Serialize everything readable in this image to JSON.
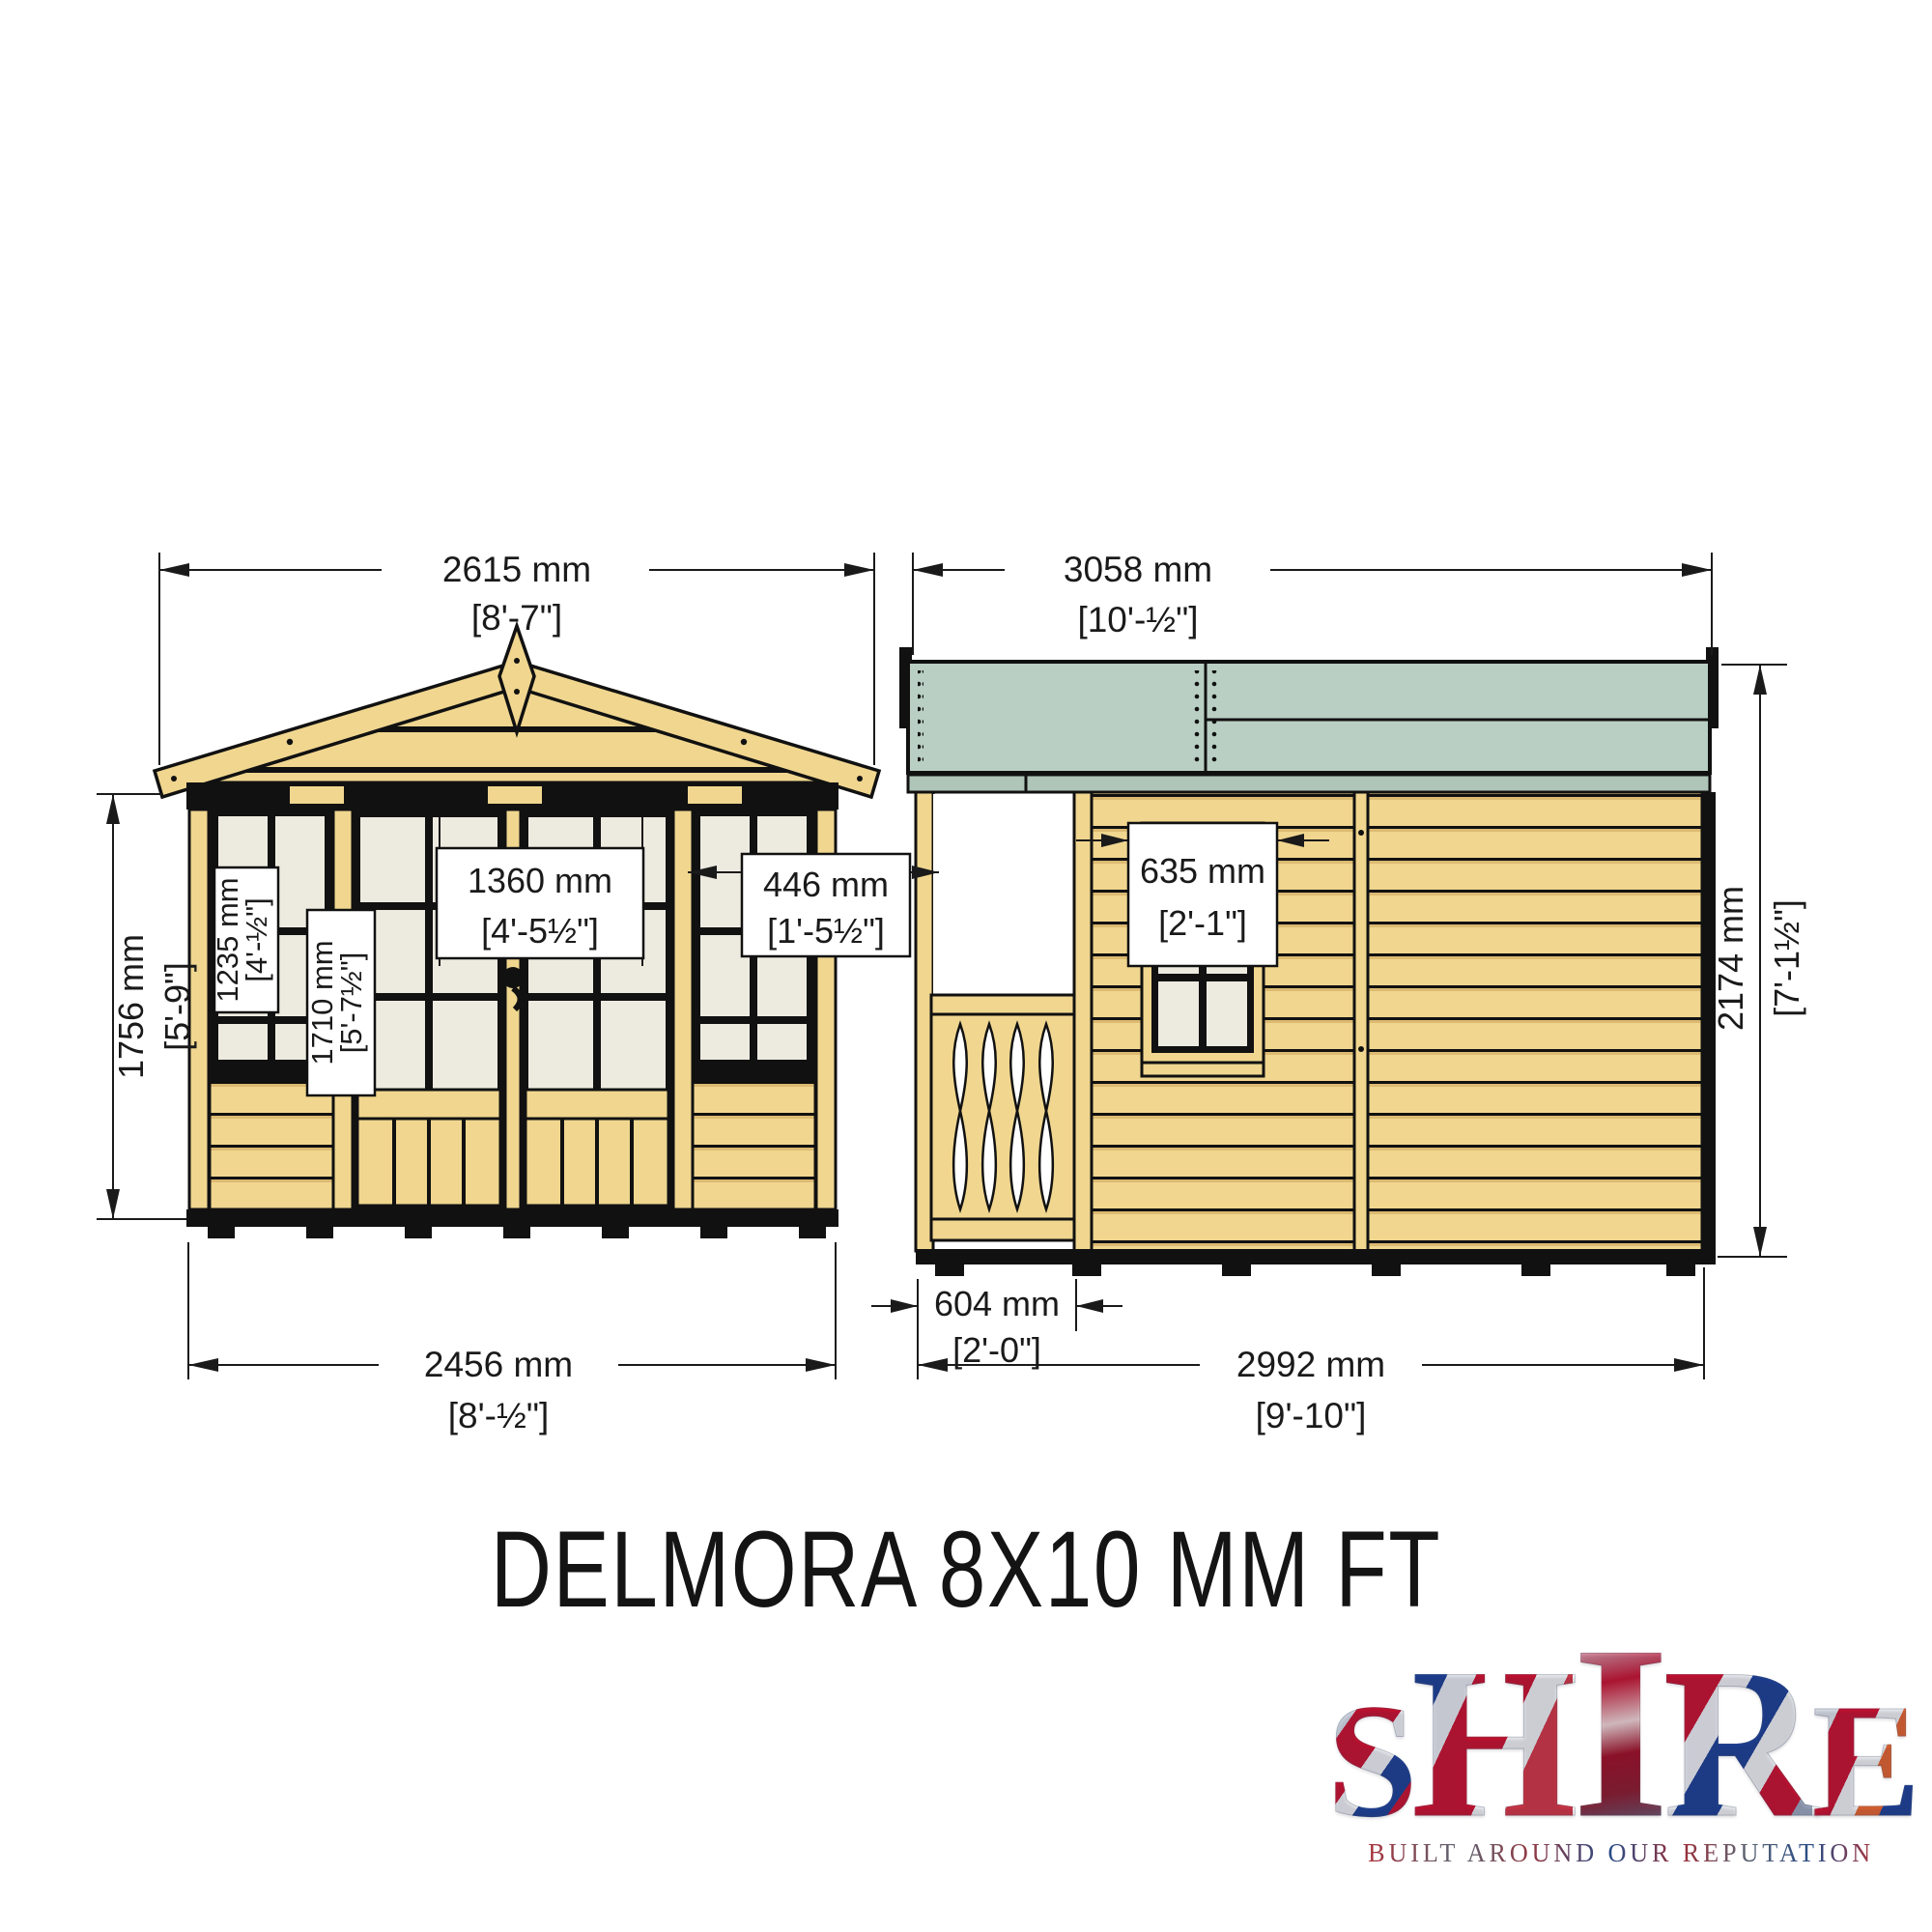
{
  "title": "DELMORA 8X10 MM FT",
  "logo": {
    "letters": [
      "S",
      "H",
      "I",
      "R",
      "E"
    ],
    "tagline": "BUILT AROUND OUR REPUTATION"
  },
  "front": {
    "roof_width_mm": "2615 mm",
    "roof_width_ft": "[8'-7\"]",
    "height_mm": "1756 mm",
    "height_ft": "[5'-9\"]",
    "window_h_mm": "1235 mm",
    "window_h_ft": "[4'-½\"]",
    "door_h_mm": "1710 mm",
    "door_h_ft": "[5'-7½\"]",
    "doors_w_mm": "1360 mm",
    "doors_w_ft": "[4'-5½\"]",
    "sidewin_w_mm": "446 mm",
    "sidewin_w_ft": "[1'-5½\"]",
    "base_w_mm": "2456 mm",
    "base_w_ft": "[8'-½\"]"
  },
  "side": {
    "roof_len_mm": "3058 mm",
    "roof_len_ft": "[10'-½\"]",
    "height_mm": "2174 mm",
    "height_ft": "[7'-1½\"]",
    "window_w_mm": "635 mm",
    "window_w_ft": "[2'-1\"]",
    "porch_mm": "604 mm",
    "porch_ft": "[2'-0\"]",
    "base_len_mm": "2992 mm",
    "base_len_ft": "[9'-10\"]"
  }
}
